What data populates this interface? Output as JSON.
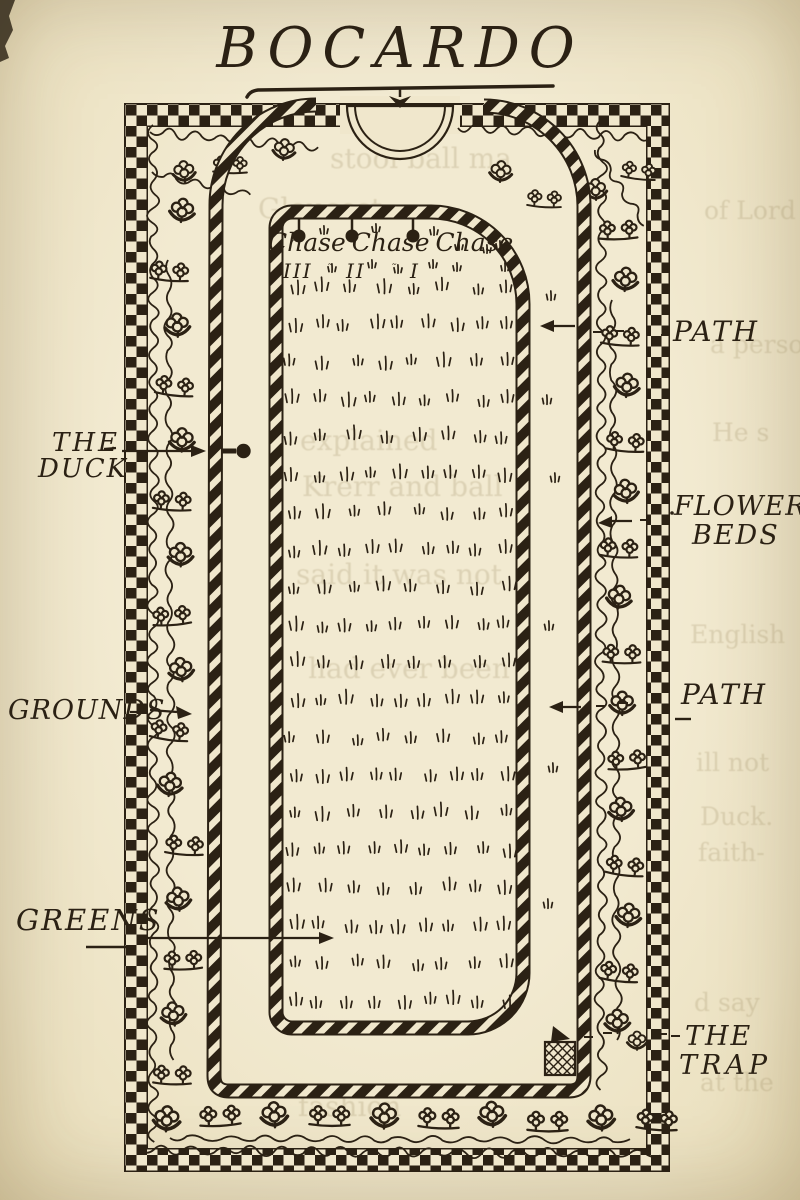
{
  "page": {
    "title": "BOCARDO",
    "paper": "#f0e7cc",
    "ink": "#2b2114"
  },
  "labels": {
    "duck": [
      "THE",
      "DUCK"
    ],
    "grounds": "GROUNDS",
    "greens": "GREENS",
    "path_upper": "PATH",
    "flower_beds": [
      "FLOWER",
      "BEDS"
    ],
    "path_lower": "PATH",
    "trap": [
      "THE",
      "TRAP"
    ]
  },
  "court": {
    "chase": [
      {
        "word": "Chase",
        "numeral": "III"
      },
      {
        "word": "Chase",
        "numeral": "II"
      },
      {
        "word": "Chase",
        "numeral": "I"
      }
    ],
    "ditto_marks": [
      "˜",
      "˜"
    ]
  },
  "bleedthrough": {
    "color": "#8f7d52",
    "items": [
      {
        "x": 330,
        "y": 142,
        "size": 28,
        "text": "stool ball ma"
      },
      {
        "x": 258,
        "y": 192,
        "size": 28,
        "text": "Gloucest"
      },
      {
        "x": 704,
        "y": 196,
        "size": 25,
        "text": "of Lord"
      },
      {
        "x": 710,
        "y": 330,
        "size": 25,
        "text": "a perso"
      },
      {
        "x": 712,
        "y": 418,
        "size": 25,
        "text": "He s"
      },
      {
        "x": 300,
        "y": 424,
        "size": 28,
        "text": "explained"
      },
      {
        "x": 302,
        "y": 470,
        "size": 28,
        "text": "Krerr and ball"
      },
      {
        "x": 296,
        "y": 558,
        "size": 28,
        "text": "said it was not"
      },
      {
        "x": 308,
        "y": 652,
        "size": 28,
        "text": "had ever been"
      },
      {
        "x": 690,
        "y": 620,
        "size": 25,
        "text": "English"
      },
      {
        "x": 696,
        "y": 748,
        "size": 25,
        "text": "ill not"
      },
      {
        "x": 700,
        "y": 802,
        "size": 25,
        "text": "Duck."
      },
      {
        "x": 698,
        "y": 838,
        "size": 25,
        "text": "faith-"
      },
      {
        "x": 694,
        "y": 988,
        "size": 25,
        "text": "d say"
      },
      {
        "x": 700,
        "y": 1068,
        "size": 25,
        "text": "at the"
      },
      {
        "x": 298,
        "y": 1090,
        "size": 28,
        "text": "fashion"
      }
    ]
  }
}
